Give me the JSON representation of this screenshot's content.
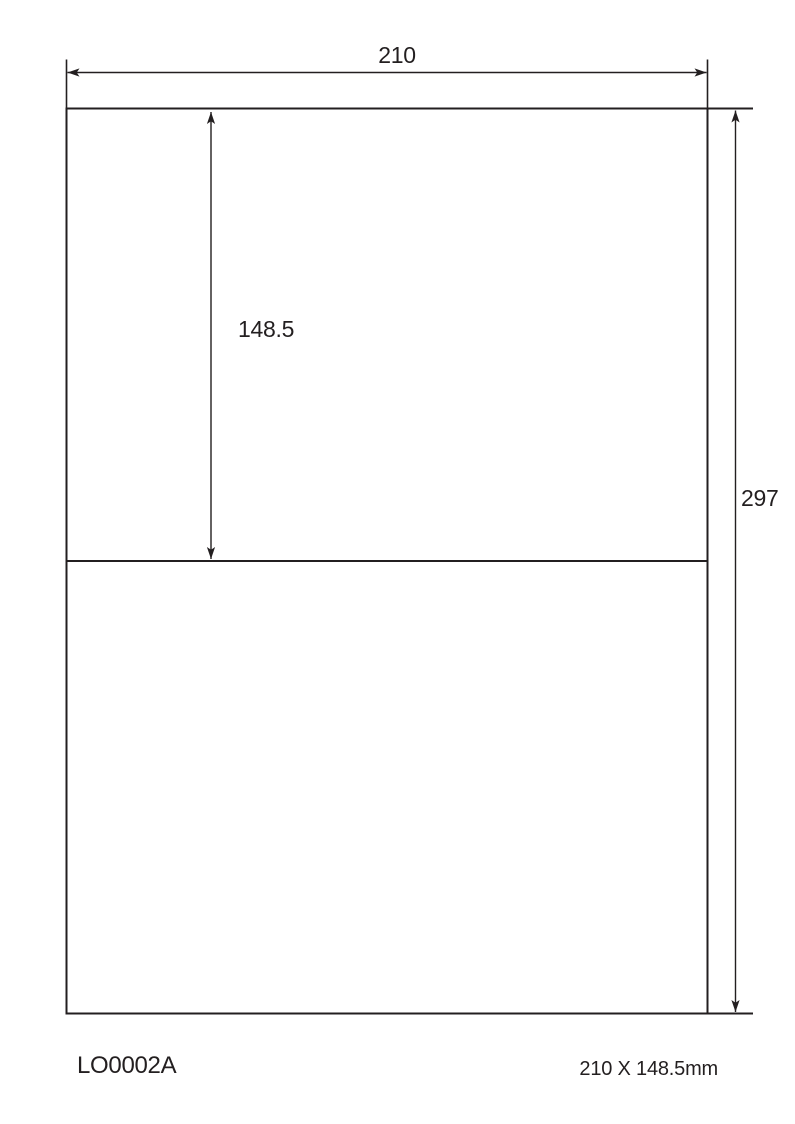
{
  "page": {
    "background_color": "#ffffff",
    "line_color": "#231f20"
  },
  "dimensions": {
    "sheet_width_label": "210",
    "label_height_label": "148.5",
    "sheet_height_label": "297"
  },
  "footer": {
    "product_code": "LO0002A",
    "size_text": "210 X 148.5mm"
  }
}
